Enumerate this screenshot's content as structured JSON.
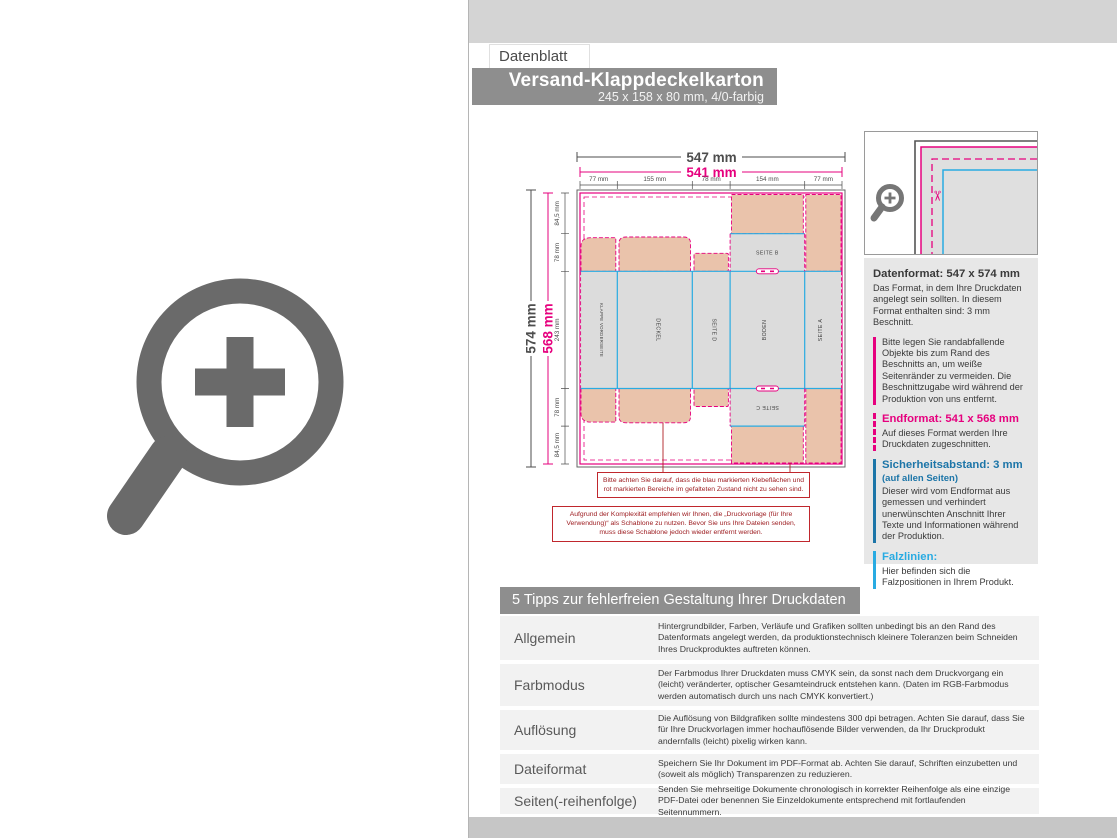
{
  "header": {
    "tab_label": "Datenblatt",
    "title": "Versand-Klappdeckelkarton",
    "subtitle": "245 x 158 x 80 mm, 4/0-farbig"
  },
  "diagram": {
    "total_width": "547 mm",
    "trim_width": "541 mm",
    "total_height": "574 mm",
    "trim_height": "568 mm",
    "col_dims": [
      "77 mm",
      "155 mm",
      "78 mm",
      "154 mm",
      "77 mm"
    ],
    "row_dims": [
      "84,5 mm",
      "78 mm",
      "243 mm",
      "78 mm",
      "84,5 mm"
    ],
    "panels": {
      "flap_front": "KLAPPE VORDERSEITE",
      "lid": "DECKEL",
      "side_d": "SEITE D",
      "bottom": "BODEN",
      "side_a": "SEITE A",
      "side_b": "SEITE B",
      "side_c": "SEITE C"
    },
    "note_blue_red": "Bitte achten Sie darauf, dass die blau markierten Klebeflächen und rot markierten Bereiche im gefalteten Zustand nicht zu sehen sind.",
    "note_template": "Aufgrund der Komplexität empfehlen wir Ihnen, die „Druckvorlage (für Ihre Verwendung)“ als Schablone zu nutzen. Bevor Sie uns Ihre Dateien senden, muss diese Schablone jedoch wieder entfernt werden."
  },
  "info_panel": {
    "sections": [
      {
        "title": "Datenformat: 547 x 574 mm",
        "body": "Das Format, in dem Ihre Druckdaten angelegt sein sollten. In diesem Format enthalten sind: 3 mm Beschnitt."
      },
      {
        "body": "Bitte legen Sie randabfallende Objekte bis zum Rand des Beschnitts an, um weiße Seitenränder zu vermeiden. Die Beschnittzugabe wird während der Produktion von uns entfernt."
      },
      {
        "title": "Endformat: 541 x 568 mm",
        "body": "Auf dieses Format werden Ihre Druckdaten zugeschnitten."
      },
      {
        "title": "Sicherheitsabstand: 3 mm",
        "subtitle": "(auf allen Seiten)",
        "body": "Dieser wird vom Endformat aus gemessen und verhindert unerwünschten Anschnitt Ihrer Texte und Informationen während der Produktion."
      },
      {
        "title": "Falzlinien:",
        "body": "Hier befinden sich die Falzpositionen in Ihrem Produkt."
      }
    ]
  },
  "tips": {
    "title": "5 Tipps zur fehlerfreien Gestaltung Ihrer Druckdaten",
    "rows": [
      {
        "label": "Allgemein",
        "text": "Hintergrundbilder, Farben, Verläufe und Grafiken sollten unbedingt bis an den Rand des Datenformats angelegt werden, da produktionstechnisch kleinere Toleranzen beim Schneiden Ihres Druckproduktes auftreten können."
      },
      {
        "label": "Farbmodus",
        "text": "Der Farbmodus Ihrer Druckdaten muss CMYK sein, da sonst nach dem Druckvorgang ein (leicht) veränderter, optischer Gesamteindruck entstehen kann. (Daten im RGB-Farbmodus werden automatisch durch uns nach CMYK konvertiert.)"
      },
      {
        "label": "Auflösung",
        "text": "Die Auflösung von Bildgrafiken sollte mindestens 300 dpi betragen. Achten Sie darauf, dass Sie für Ihre Druckvorlagen immer hochauflösende Bilder verwenden, da Ihr Druckprodukt andernfalls (leicht) pixelig wirken kann."
      },
      {
        "label": "Dateiformat",
        "text": "Speichern Sie Ihr Dokument im PDF-Format ab. Achten Sie darauf, Schriften einzubetten und (soweit als möglich) Transparenzen zu reduzieren."
      },
      {
        "label": "Seiten(-reihenfolge)",
        "text": "Senden Sie mehrseitige Dokumente chronologisch in korrekter Reihenfolge als eine einzige PDF-Datei oder benennen Sie Einzeldokumente entsprechend mit fortlaufenden Seitennummern."
      }
    ]
  },
  "icons": {
    "scissors": "✂"
  },
  "colors": {
    "magenta": "#e6007e",
    "cyan": "#29abe2",
    "blue": "#1c75a8",
    "note_red": "#b01f24",
    "bar_gray": "#8e8e8e",
    "flap_salmon": "#eac3ab",
    "panel_gray": "#dcdcdc",
    "icon_gray": "#6a6a6a"
  }
}
